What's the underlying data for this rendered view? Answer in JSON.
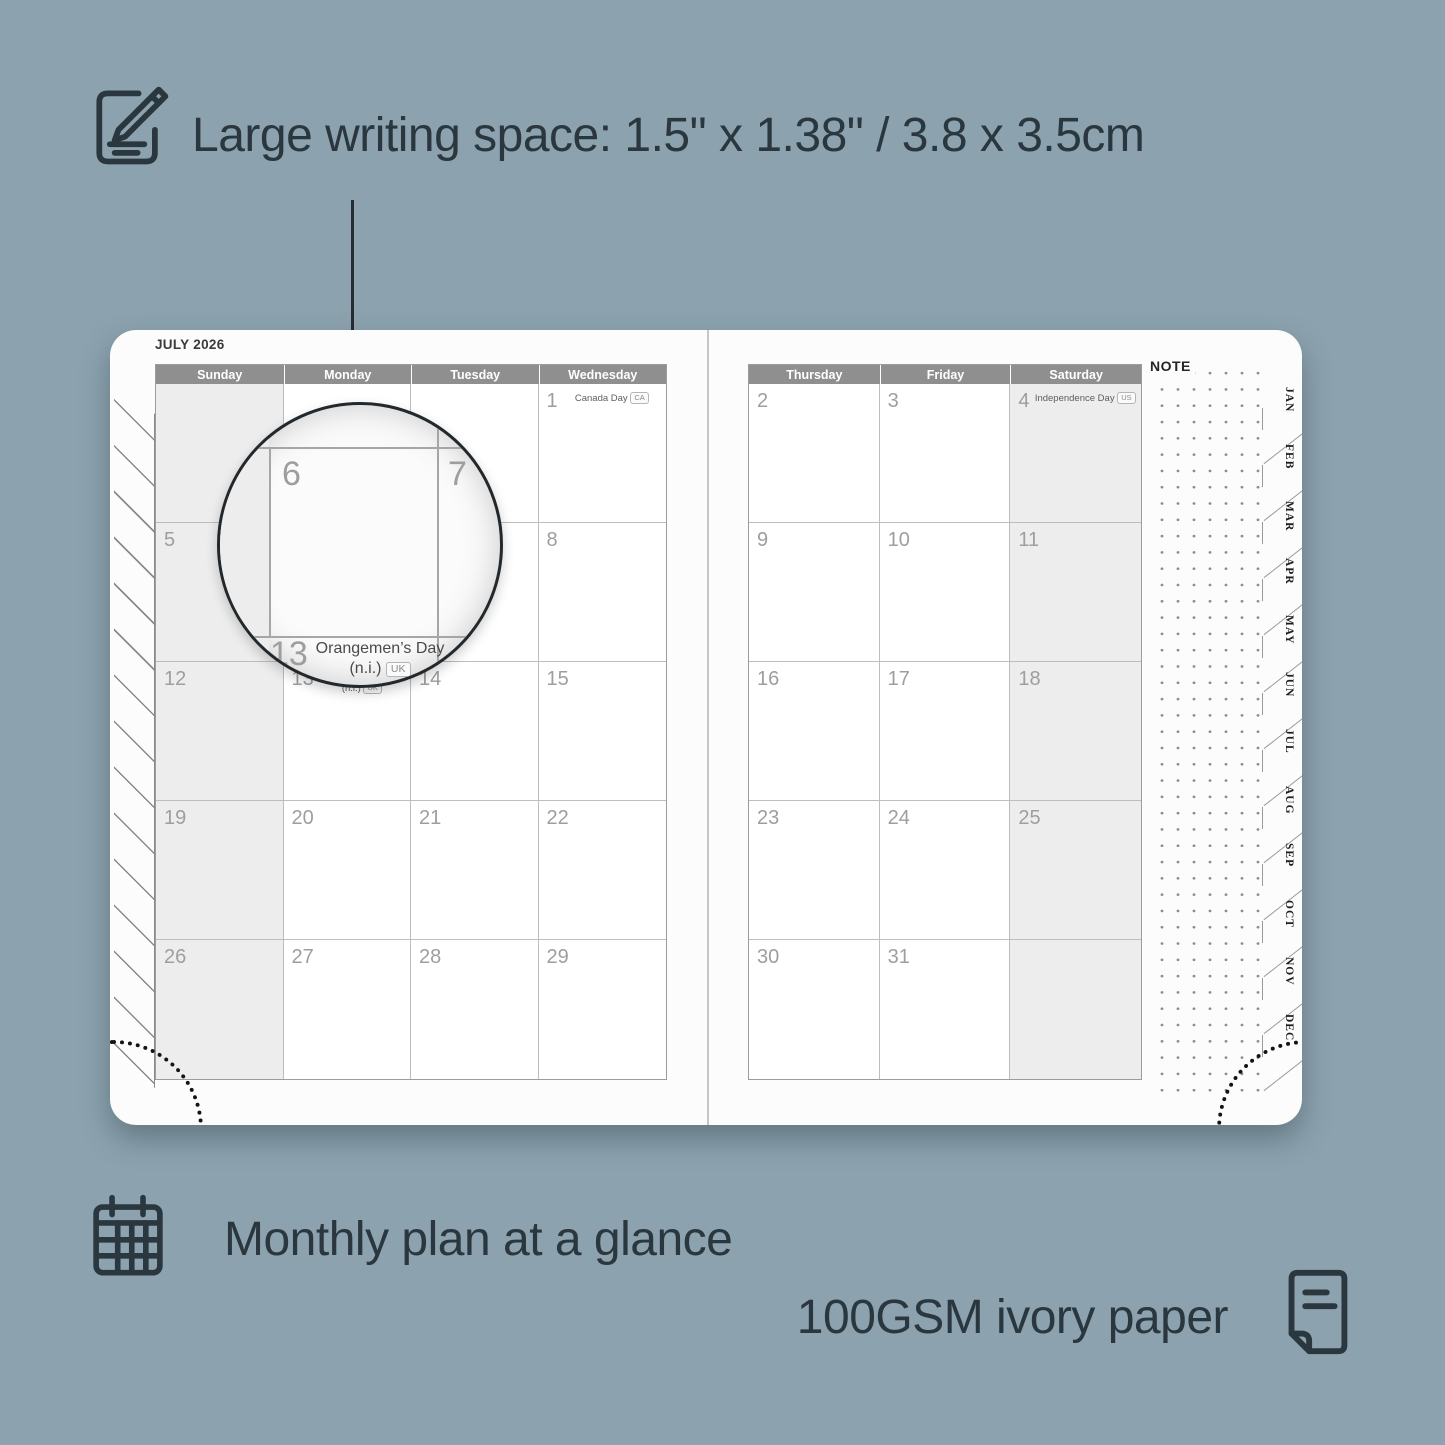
{
  "colors": {
    "background": "#8CA3AF",
    "ink": "#2B373E",
    "page": "#FCFCFC",
    "header_bar": "#8F8F8F",
    "weekend_shade": "#EDEDED",
    "grid_line": "#BDBDBD",
    "date_number": "#9E9E9E"
  },
  "features": {
    "writing_space": {
      "label": "Large writing space: 1.5\" x 1.38\" / 3.8 x 3.5cm",
      "icon": "pencil-pad-icon"
    },
    "monthly_plan": {
      "label": "Monthly plan at a glance",
      "icon": "calendar-grid-icon"
    },
    "paper": {
      "label": "100GSM ivory paper",
      "icon": "paper-icon"
    }
  },
  "planner": {
    "month_title": "JULY 2026",
    "note_label": "NOTE",
    "left_headers": [
      "Sunday",
      "Monday",
      "Tuesday",
      "Wednesday"
    ],
    "right_headers": [
      "Thursday",
      "Friday",
      "Saturday"
    ],
    "month_tabs": [
      "JAN",
      "FEB",
      "MAR",
      "APR",
      "MAY",
      "JUN",
      "JUL",
      "AUG",
      "SEP",
      "OCT",
      "NOV",
      "DEC"
    ],
    "left_rows": [
      [
        {
          "d": ""
        },
        {
          "d": ""
        },
        {
          "d": ""
        },
        {
          "d": "1",
          "h": "Canada Day",
          "b": "CA"
        }
      ],
      [
        {
          "d": "5"
        },
        {
          "d": "6"
        },
        {
          "d": "7"
        },
        {
          "d": "8"
        }
      ],
      [
        {
          "d": "12"
        },
        {
          "d": "13",
          "h": "Orangemen’s Day",
          "h2": "(n.i.)",
          "b": "UK"
        },
        {
          "d": "14"
        },
        {
          "d": "15"
        }
      ],
      [
        {
          "d": "19"
        },
        {
          "d": "20"
        },
        {
          "d": "21"
        },
        {
          "d": "22"
        }
      ],
      [
        {
          "d": "26"
        },
        {
          "d": "27"
        },
        {
          "d": "28"
        },
        {
          "d": "29"
        }
      ]
    ],
    "right_rows": [
      [
        {
          "d": "2"
        },
        {
          "d": "3"
        },
        {
          "d": "4",
          "h": "Independence Day",
          "b": "US"
        }
      ],
      [
        {
          "d": "9"
        },
        {
          "d": "10"
        },
        {
          "d": "11"
        }
      ],
      [
        {
          "d": "16"
        },
        {
          "d": "17"
        },
        {
          "d": "18"
        }
      ],
      [
        {
          "d": "23"
        },
        {
          "d": "24"
        },
        {
          "d": "25"
        }
      ],
      [
        {
          "d": "30"
        },
        {
          "d": "31"
        },
        {
          "d": ""
        }
      ]
    ],
    "magnifier": {
      "day_top_left": "6",
      "day_top_right": "7",
      "day_bottom": "13",
      "holiday_line1": "Orangemen’s Day",
      "holiday_line2": "(n.i.)",
      "badge": "UK"
    }
  }
}
